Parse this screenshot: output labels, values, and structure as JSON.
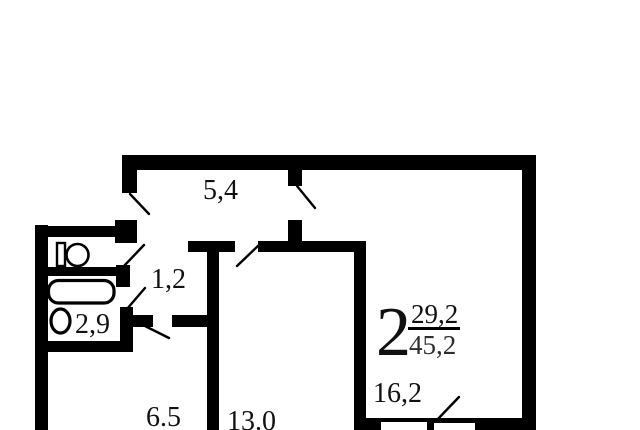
{
  "title": "apartment-floor-plan",
  "summary": {
    "rooms_count": "2",
    "living_area": "29,2",
    "total_area": "45,2"
  },
  "rooms": {
    "corridor": {
      "area": "5,4"
    },
    "wc": {
      "area": "1,2"
    },
    "bathroom": {
      "area": "2,9"
    },
    "hallway": {
      "area": "6.5"
    },
    "room_a": {
      "area": "13.0"
    },
    "room_b": {
      "area": "16,2"
    }
  },
  "fixtures": [
    "toilet",
    "bathtub",
    "sink",
    "window",
    "door-swings"
  ],
  "colors": {
    "wall": "#000000",
    "background": "#ffffff",
    "text": "#111111"
  }
}
